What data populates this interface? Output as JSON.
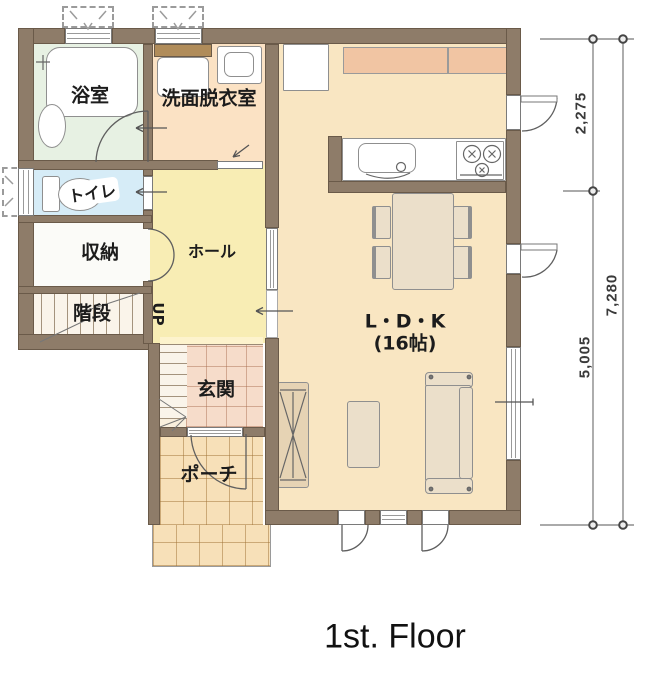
{
  "title": "1st. Floor",
  "rooms": {
    "bath": "浴室",
    "washroom": "洗面脱衣室",
    "toilet": "トイレ",
    "storage": "収納",
    "stairs": "階段",
    "hall": "ホール",
    "entrance": "玄関",
    "porch": "ポーチ",
    "ldk": "L・D・K",
    "ldk_size": "(16帖)"
  },
  "stairs_direction": "UP",
  "dimensions": {
    "upper_right": "2,275",
    "total_right": "7,280",
    "lower_right": "5,005"
  },
  "colors": {
    "wall": "#8e7c69",
    "wall-outline": "#6a5a49",
    "floor-ldk": "#f9e6c2",
    "floor-hall": "#f8edb4",
    "floor-bath": "#e7f1e3",
    "floor-toilet": "#d6ecf7",
    "floor-washroom": "#fbe2c4",
    "floor-storage": "#fbfbf8",
    "floor-stairs": "#faf4ea",
    "tile-entrance": "#f6dcca",
    "tile-porch": "#f7e0b8",
    "counter": "#f1c5a3",
    "furniture": "#ebdfca"
  }
}
